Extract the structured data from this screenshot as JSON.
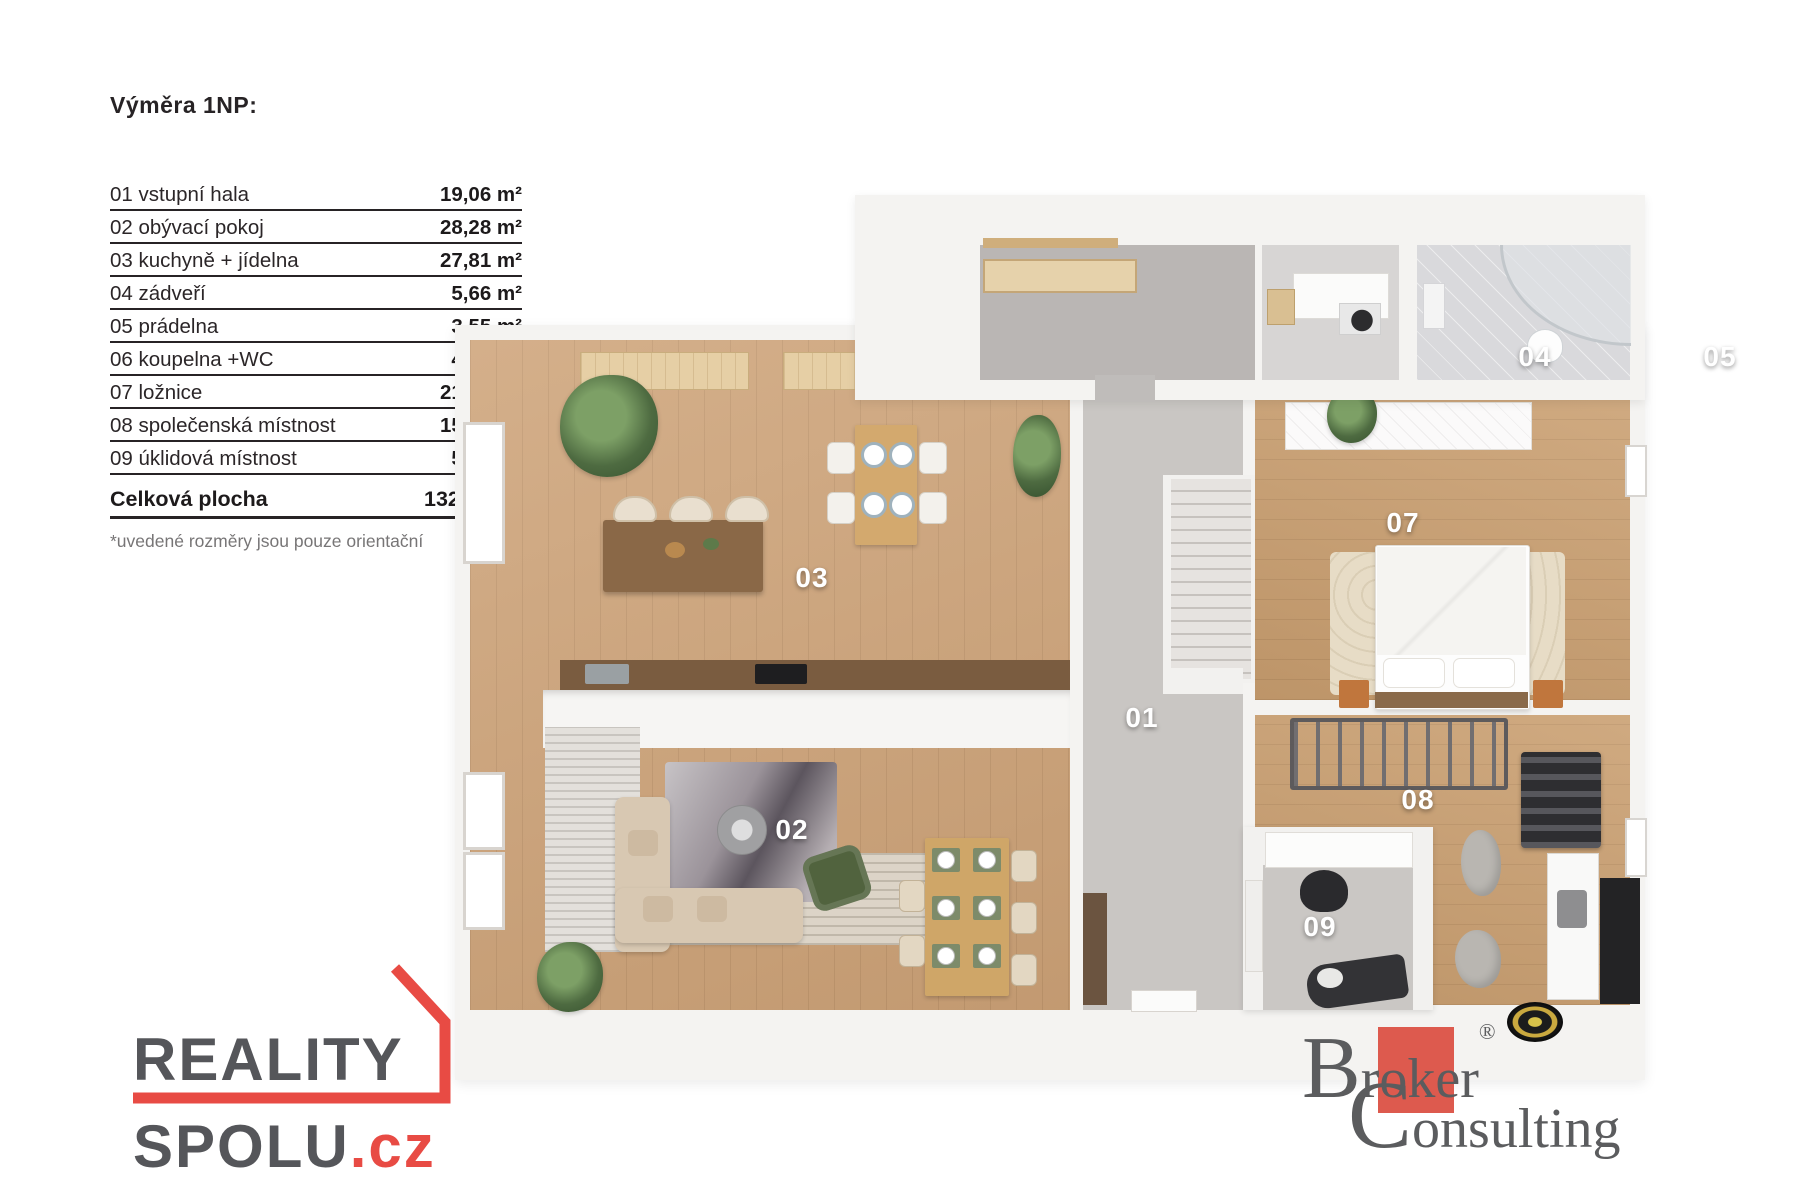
{
  "legend": {
    "title": "Výměra 1NP:",
    "rows": [
      {
        "label": "01 vstupní hala",
        "area": "19,06 m²"
      },
      {
        "label": "02 obývací pokoj",
        "area": "28,28 m²"
      },
      {
        "label": "03 kuchyně + jídelna",
        "area": "27,81 m²"
      },
      {
        "label": "04 zádveří",
        "area": "5,66 m²"
      },
      {
        "label": "05 prádelna",
        "area": "3,55 m²"
      },
      {
        "label": "06 koupelna +WC",
        "area": "4,92 m²"
      },
      {
        "label": "07 ložnice",
        "area": "21,80 m²"
      },
      {
        "label": "08 společenská místnost",
        "area": "15,90 m²"
      },
      {
        "label": "09 úklidová místnost",
        "area": "5,79 m²"
      }
    ],
    "total_label": "Celková plocha",
    "total_area": "132,77 m²",
    "footnote": "*uvedené rozměry jsou pouze orientační"
  },
  "plan": {
    "labels": {
      "r01": "01",
      "r02": "02",
      "r03": "03",
      "r04": "04",
      "r05": "05",
      "r06": "06",
      "r07": "07",
      "r08": "08",
      "r09": "09"
    }
  },
  "logos": {
    "reality_spolu": {
      "word_top": "REALITY",
      "word_bottom": "SPOLU",
      "tld": ".cz"
    },
    "broker": {
      "b": "B",
      "roker": "roker",
      "reg": "®",
      "c": "C",
      "onsulting": "onsulting"
    }
  },
  "colors": {
    "brand_red": "#E84B44",
    "broker_red": "#DD5A4E",
    "logo_gray": "#55565A",
    "floor_wood": "#CDA277",
    "hall_gray": "#C9C6C3",
    "wall_white": "#F4F3F1"
  }
}
